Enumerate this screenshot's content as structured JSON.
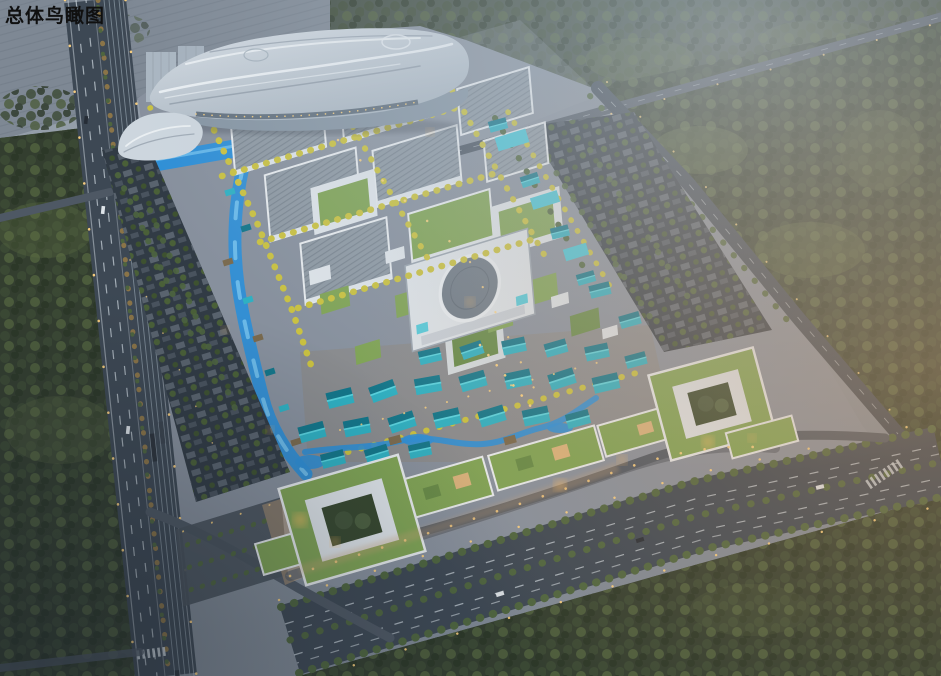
{
  "title": {
    "text": "总体鸟瞰图"
  },
  "scene": {
    "type": "architectural-aerial-rendering",
    "time_of_day": "dusk"
  },
  "colors": {
    "title": "#101010",
    "bg_top": "#99a3ae",
    "bg_bottom": "#7e8894",
    "haze": "#b7c4d0",
    "warm_haze": "#c89a6e",
    "vignette": "#1c242e",
    "field": "#7e8894",
    "forest_dark": "#333e2f",
    "forest_light": "#5f7046",
    "road": "#3d4854",
    "road_minor": "#4e5864",
    "lane_line": "#cfd8df",
    "rail": "#8a97a3",
    "campus_ground": "#87909d",
    "path": "#aeb5bf",
    "hall_light": "#d8dfe6",
    "hall_mid": "#aab6c1",
    "hall_dark": "#8695a3",
    "glass": "#5a6876",
    "bldg_white": "#dde3e8",
    "bldg_shadow": "#9aa5b0",
    "roof_gray": "#7d8994",
    "roof_dark": "#6e7a86",
    "roof_green": "#7fa355",
    "roof_green_dark": "#668a47",
    "roof_teal": "#2fb0c2",
    "roof_teal_dark": "#13768a",
    "teal_light": "#46c6d8",
    "water": "#2f8fd6",
    "water_light": "#79c4ef",
    "tree_gold": "#c9c140",
    "tree_green": "#4e653f",
    "tree_autumn": "#8a7448",
    "villa": "#313b45",
    "court_trees": "#37482f",
    "hole_warm": "#d9b27c",
    "plaza_warm": "#c9a377",
    "light_warm": "#ffd37f",
    "glow": "#ffbd62",
    "parapet": "#e6eaed"
  }
}
